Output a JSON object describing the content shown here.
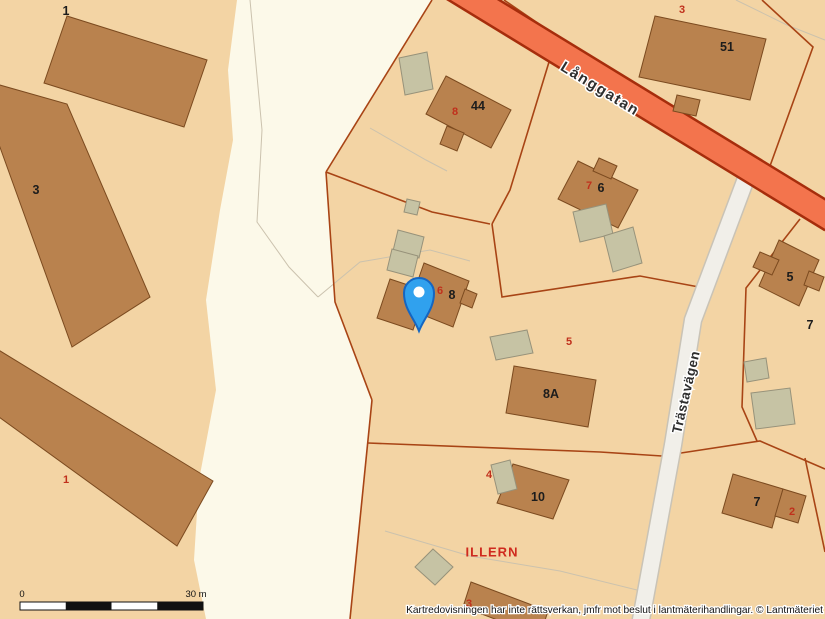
{
  "map": {
    "attribution": "Kartredovisningen har inte rättsverkan, jmfr mot beslut i lantmäterihandlingar. © Lantmäteriet",
    "scale_bar": {
      "start_label": "0",
      "end_label": "30 m"
    },
    "streets": {
      "langgatan": "Långgatan",
      "trastavagen": "Trästavägen"
    },
    "block_name": "ILLERN",
    "marker": {
      "name": "location-pin"
    },
    "colors": {
      "background": "#f3d4a4",
      "open_area": "#fcf9e9",
      "building_fill": "#b9824e",
      "outbuilding_fill": "#c6c3a4",
      "main_road_fill": "#f3744d",
      "main_road_border": "#a62d0c",
      "minor_road_fill": "#f1efe9",
      "parcel_line": "#a84415",
      "building_number_color": "#1c1c1c",
      "parcel_number_color": "#c0301c",
      "pin_fill": "#30a1ee",
      "pin_border": "#1466c2"
    },
    "building_numbers": [
      {
        "text": "1"
      },
      {
        "text": "3"
      },
      {
        "text": "51"
      },
      {
        "text": "44"
      },
      {
        "text": "6"
      },
      {
        "text": "8"
      },
      {
        "text": "8A"
      },
      {
        "text": "10"
      },
      {
        "text": "5"
      },
      {
        "text": "7"
      },
      {
        "text": "7"
      }
    ],
    "parcel_numbers": [
      {
        "text": "3"
      },
      {
        "text": "8"
      },
      {
        "text": "7"
      },
      {
        "text": "6"
      },
      {
        "text": "5"
      },
      {
        "text": "4"
      },
      {
        "text": "3"
      },
      {
        "text": "2"
      },
      {
        "text": "1"
      }
    ]
  }
}
